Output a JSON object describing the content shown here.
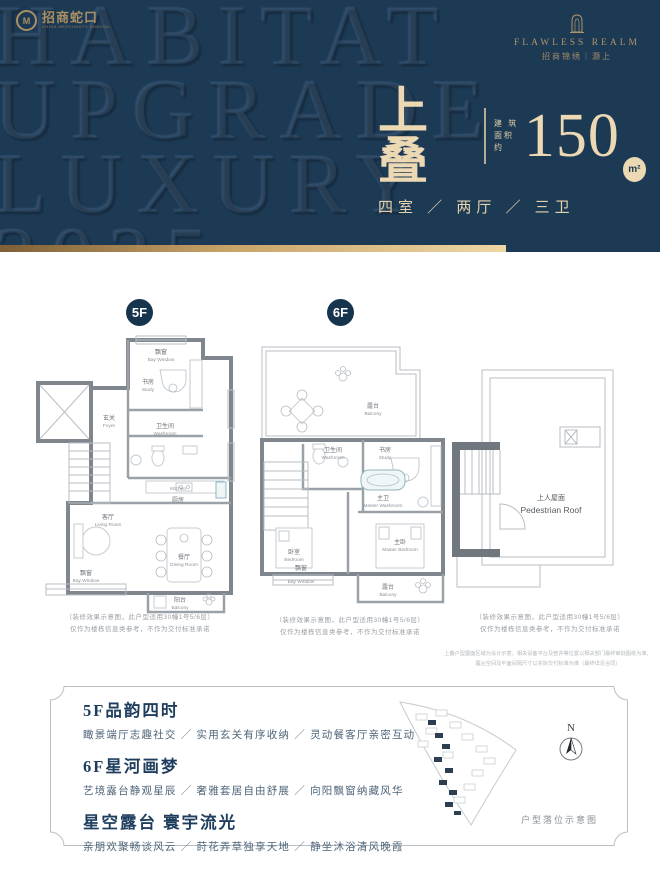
{
  "brand_left": {
    "name": "招商蛇口",
    "sub": "CHINA MERCHANTS SHEKOU",
    "mark": "M"
  },
  "brand_right": {
    "en": "FLAWLESS REALM",
    "cn": "招商锦绣｜灏上"
  },
  "watermark": {
    "line1": "HABITAT",
    "line2": "UPGRADE",
    "line3": "LUXURY",
    "line4": "2025"
  },
  "headline": {
    "title": "上叠",
    "area_label_1": "建 筑",
    "area_label_2": "面积约",
    "area_value": "150",
    "area_unit": "m²",
    "spec": "四室 ／ 两厅 ／ 三卫"
  },
  "floor5": {
    "badge": "5F",
    "rooms": {
      "bay_top": {
        "cn": "飘窗",
        "en": "Bay Window"
      },
      "study": {
        "cn": "书房",
        "en": "Study"
      },
      "foyer": {
        "cn": "玄关",
        "en": "Foyer"
      },
      "washroom": {
        "cn": "卫生间",
        "en": "Washroom"
      },
      "kitchen": {
        "cn": "厨房",
        "en": "Kitchen"
      },
      "living": {
        "cn": "客厅",
        "en": "Living Room"
      },
      "dining": {
        "cn": "餐厅",
        "en": "Dining Room"
      },
      "bay_bottom": {
        "cn": "飘窗",
        "en": "Bay Window"
      },
      "balcony": {
        "cn": "阳台",
        "en": "Balcony"
      }
    }
  },
  "floor6": {
    "badge": "6F",
    "rooms": {
      "terrace": {
        "cn": "露台",
        "en": "Balcony"
      },
      "washroom": {
        "cn": "卫生间",
        "en": "Washroom"
      },
      "study": {
        "cn": "书房",
        "en": "Study"
      },
      "master_wash": {
        "cn": "主卫",
        "en": "Master Washroom"
      },
      "master_bed": {
        "cn": "主卧",
        "en": "Master Bedroom"
      },
      "bedroom": {
        "cn": "卧室",
        "en": "Bedroom"
      },
      "bay_bottom": {
        "cn": "飘窗",
        "en": "Bay Window"
      },
      "balcony": {
        "cn": "露台",
        "en": "Balcony"
      }
    }
  },
  "roof": {
    "cn": "上人屋面",
    "en": "Pedestrian Roof"
  },
  "disclaimer": {
    "line1": "（装修效果示意图，此户型适用30幢1号5/6层）",
    "line2": "仅作为楼栋信息类参考，不作为交付标准承诺"
  },
  "roof_note": {
    "line1": "上叠户型屋面区域为设计示意，相关设备平台及管井等位置以相关部门最终审批图纸为准，",
    "line2": "露台空间及平面间隔尺寸以实际交付标准为准（最终详见合同）"
  },
  "features": {
    "items": [
      {
        "title": "5F品韵四时",
        "desc": "瞰景端厅志趣社交 ／ 实用玄关有序收纳 ／ 灵动餐客厅亲密互动"
      },
      {
        "title": "6F星河画梦",
        "desc": "艺境露台静观星辰 ／ 奢雅套居自由舒展 ／ 向阳飘窗纳藏风华"
      },
      {
        "title": "星空露台 寰宇流光",
        "desc": "亲朋欢聚畅谈风云 ／ 莳花弄草独享天地 ／ 静坐沐浴清风晚霞"
      }
    ]
  },
  "siteplan": {
    "compass": "N",
    "caption": "户型落位示意图"
  }
}
